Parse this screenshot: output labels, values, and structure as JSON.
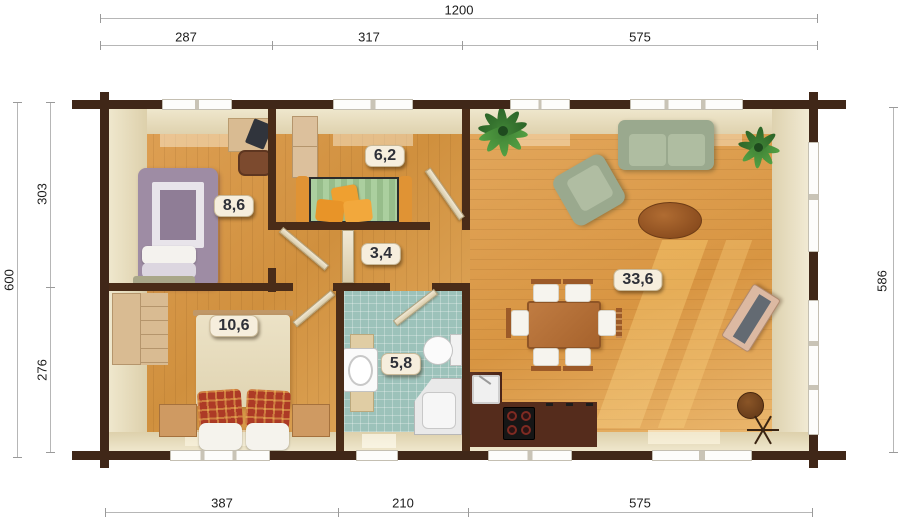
{
  "plan": {
    "dimensions": {
      "top_total": "1200",
      "top_segments": [
        "287",
        "317",
        "575"
      ],
      "left_total": "600",
      "left_segments": [
        "303",
        "276"
      ],
      "right_total": "586",
      "bottom_segments": [
        "387",
        "210",
        "575"
      ]
    },
    "rooms": {
      "bedroom_top": {
        "area_label": "8,6"
      },
      "kids_room": {
        "area_label": "6,2"
      },
      "hallway": {
        "area_label": "3,4"
      },
      "bedroom_bottom": {
        "area_label": "10,6"
      },
      "bathroom": {
        "area_label": "5,8"
      },
      "living_room": {
        "area_label": "33,6"
      }
    },
    "colors": {
      "wall": "#402718",
      "floor_wood": "#dda254",
      "inner_band": "#e6dcbf",
      "bathroom_tile": "#9cc2ba",
      "badge_bg": "#f6eedd",
      "dimension_text": "#1c1c1c"
    }
  }
}
